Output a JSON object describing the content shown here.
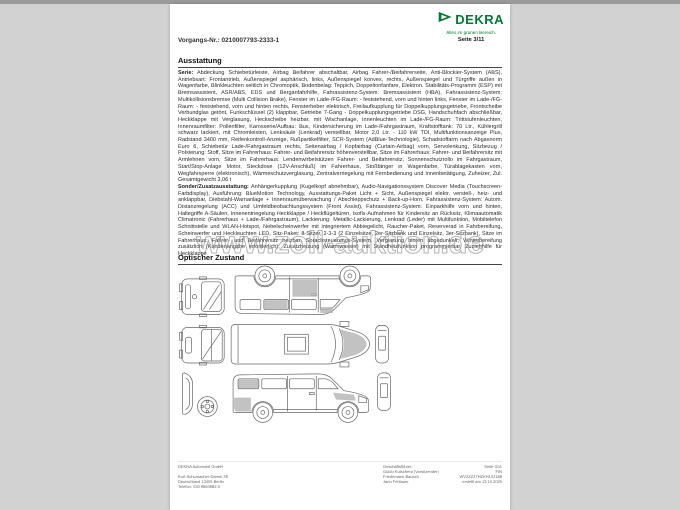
{
  "header": {
    "vorgangs_nr": "Vorgangs-Nr.: 0210007793-2333-1",
    "logo_word": "DEKRA",
    "tagline": "Alles im grünen Bereich.",
    "page_label": "Seite 3/11"
  },
  "colors": {
    "brand_green": "#007A33",
    "damage_shade_gray": "#b3b3b3",
    "page_background": "#ffffff",
    "desktop_background": "#d2d2d2"
  },
  "sections": {
    "ausstattung_title": "Ausstattung",
    "serie_lead": "Serie:",
    "serie_text": "Abdeckung Schiebetürleiste, Airbag Beifahrer abschaltbar, Airbag Fahrer-/Beifahrerseite, Anti-Blockier-System (ABS), Antriebsart: Frontantrieb, Außenspiegel asphärisch, links, Außenspiegel konvex, rechts, Außenspiegel und Türgriffe außen in Wagenfarbe, Blinkleuchten seitlich in Chromoptik, Bodenbelag: Teppich, Doppeltonfanfare, Elektron. Stabilitäts-Programm (ESP) mit Bremsassistent, ASR/ABS, EDS und Berganfahrhilfe, Fahrassistenz-System: Bremsassistent (HBA), Fahrassistenz-System: Multikollisionsbremse (Multi Collision Brake), Fenster im Lade-/FG-Raum: - feststehend, vorn und hinten links, Fenster im Lade-/FG-Raum: - feststehend, vorn und hinten rechts, Fensterheber elektrisch, Freilaufkupplung für Doppelkupplungsgetriebe, Frontscheibe Verbundglas getönt, Funkschlüssel (2) klappbar, Getriebe 7-Gang - Doppelkupplungsgetriebe DSG, Handschuhfach abschließbar, Heckklappe mit Verglasung, Heckscheibe heizbar, mit Wischanlage, Innenleuchten im Lade-/FG-Raum: Trittstufenleuchten, Innenraumfilter: Pollenfilter, Karosserie/Aufbau: Bus, Kindersicherung im Lade-/Fahrgastraum, Kraftstofftank: 70 Ltr., Kühlergrill schwarz lackiert, mit Chromleisten, Lenksäule (Lenkrad) verstellbar, Motor 2,0 Ltr. - 110 kW TDI, Multifunktionsanzeige Plus, Radstand 3400 mm, Reifenkontroll-Anzeige, Rußpartikelfilter, SCR-System (AdBlue-Technologie), Schadstoffarm nach Abgasnorm Euro 6, Schiebetür Lade-/Fahrgastraum rechts, Seitenairbag / Kopfairbag (Curtain-Airbag) vorn, Servolenkung, Sitzbezug / Polsterung: Stoff, Sitze im Fahrerhaus: Fahrer- und Beifahrersitz höhenverstellbar, Sitze im Fahrerhaus: Fahrer- und Beifahrersitz mit Armlehnen vorn, Sitze im Fahrerhaus: Lendenwirbelstützen Fahrer- und Beifahrersitz, Sonnenschutzrollo im Fahrgastraum, Start/Stop-Anlage Motor, Steckdose (12V-Anschluß) im Fahrerhaus, Stoßfänger in Wagenfarbe, Türablagekasten vorn, Wegfahrsperre (elektronisch), Wärmeschutzverglasung, Zentralverriegelung mit Fernbedienung und Innenbetätigung, Zuheizer, Zul. Gesamtgewicht 3,06 t",
    "sonder_lead": "Sonder/Zusatzausstattung:",
    "sonder_text": "Anhängerkupplung (Kugelkopf abnehmbar), Audio-Navigationssystem Discover Media (Touchscreen-Farbdisplay), Ausführung: BlueMotion Technology, Ausstattungs-Paket Licht + Sicht, Außenspiegel elektr. verstell-, heiz- und anklappbar, Diebstahl-Warnanlage + Innenraumüberwachung / Abschleppschutz + Back-up-Horn, Fahrassistenz-System: Autom. Distanzregelung (ACC) und Umfeldbeobachtungssystem (Front Assist), Fahrassistenz-System: Einparkhilfe vorn und hinten, Haltegriffe A-Säulen, Innenentriegelung Heckklappe / Heckflügeltüren, Isofix-Aufnahmen für Kindersitz an Rücksitz, Klimaautomatik Climatronic (Fahrerhaus + Lade-/Fahrgastraum), Lackierung: Metallic-Lackierung, Lenkrad (Leder) mit Multifunktion, Mobiltelefon Schnittstelle und WLAN-Hotspot, Nebelscheinwerfer mit integriertem Abbiegelicht, Raucher-Paket, Reserverad in Fahrbereifung, Scheinwerfer und Heckleuchten LED, Sitz-Paket: 8-Sitzer, 2-3-3 (2 Einzelsitze, 2er-Sitzbank und Einzelsitz, 3er-Sitzbank), Sitze im Fahrerhaus: Fahrer- und Beifahrersitz heizbar, Sprachsteuerungs-System, Verglasung hinten abgedunkelt, Winterbereifung zusätzlich (Kundenangabe erforderlich), Zusatzheizung (Warmwasser) mit Standheizfunktion programmierbar, Zuziehhilfe für Heckklappe",
    "optischer_title": "Optischer Zustand"
  },
  "watermark": {
    "text": "www.zoll-auktion.de"
  },
  "diagrams": {
    "views": [
      "front-view-rotated",
      "left-side-view-inverted",
      "rear-view-rotated",
      "top-view",
      "door-panel-part",
      "front-bumper-part",
      "spare-wheel",
      "right-side-view",
      "rear-panel-part"
    ]
  },
  "footer": {
    "company": [
      "DEKRA Automobil GmbH",
      "",
      "Kurt-Schumacher-Damm 28",
      "Deutschland 13405 Berlin",
      "Telefon: 030 9860982-0"
    ],
    "management": [
      "Geschäftsführer:",
      "Guido Kutschera (Vorsitzender)",
      "Friedemann Bausch",
      "Jann Fehlauer"
    ],
    "meta": [
      "Seite 3/11",
      "FIN WV2ZZZ7HZKH102188",
      "erstellt am 13.10.2025"
    ]
  }
}
